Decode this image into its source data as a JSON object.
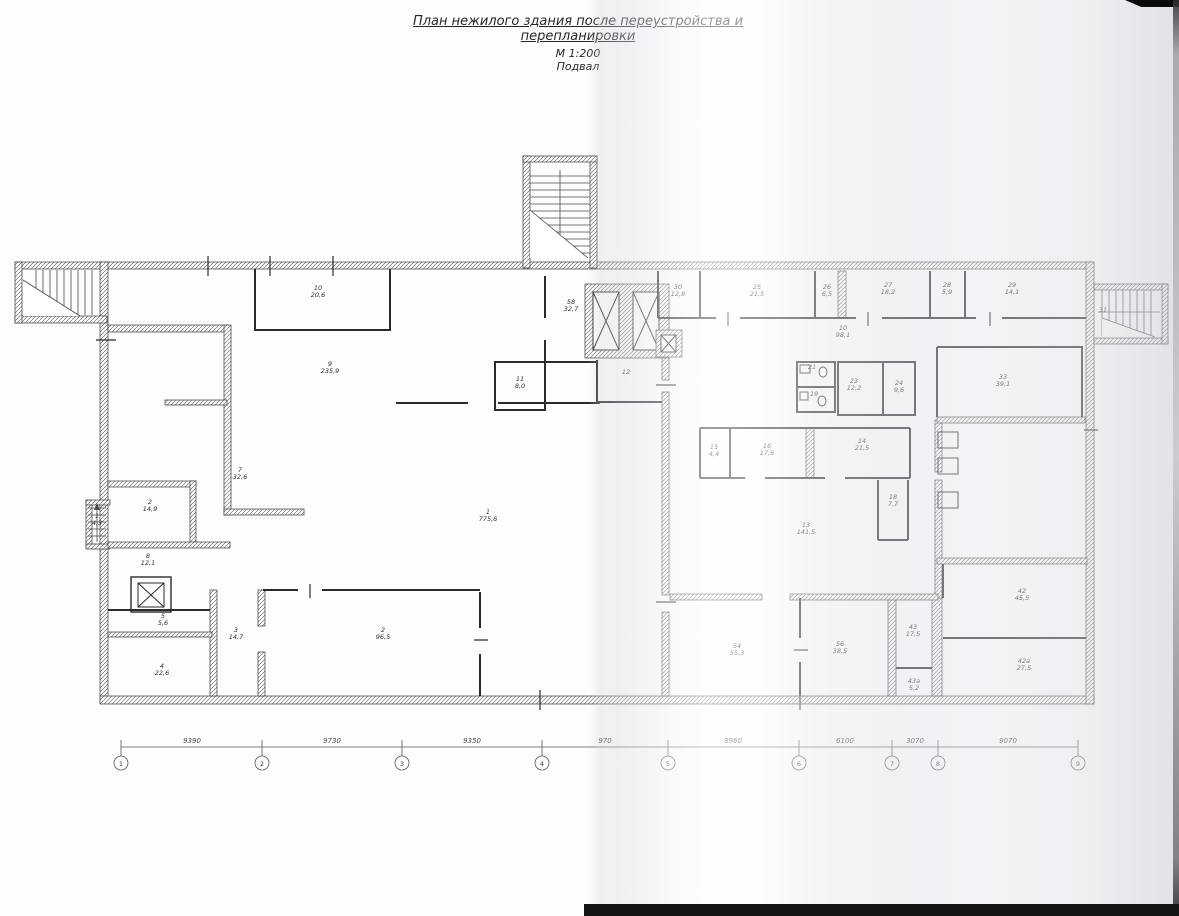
{
  "title": {
    "line1": "План нежилого здания после переустройства и перепланировки",
    "line2": "М 1:200",
    "line3": "Подвал"
  },
  "rooms": [
    {
      "num": "10",
      "area": "20,6"
    },
    {
      "num": "9",
      "area": "235,9"
    },
    {
      "num": "7",
      "area": "32,6"
    },
    {
      "num": "2",
      "area": "14,9"
    },
    {
      "num": "1",
      "area": "4,3"
    },
    {
      "num": "8",
      "area": "12,1"
    },
    {
      "num": "5",
      "area": "5,6"
    },
    {
      "num": "4",
      "area": "22,6"
    },
    {
      "num": "3",
      "area": "14,7"
    },
    {
      "num": "2",
      "area": "96,5"
    },
    {
      "num": "1",
      "area": "775,6"
    },
    {
      "num": "11",
      "area": "8,0"
    },
    {
      "num": "58",
      "area": "32,7"
    },
    {
      "num": "12",
      "area": ""
    },
    {
      "num": "30",
      "area": "12,8"
    },
    {
      "num": "25",
      "area": "21,5"
    },
    {
      "num": "26",
      "area": "6,5"
    },
    {
      "num": "27",
      "area": "18,2"
    },
    {
      "num": "28",
      "area": "5,9"
    },
    {
      "num": "29",
      "area": "14,1"
    },
    {
      "num": "31",
      "area": ""
    },
    {
      "num": "10",
      "area": "98,1"
    },
    {
      "num": "21",
      "area": ""
    },
    {
      "num": "19",
      "area": ""
    },
    {
      "num": "23",
      "area": "12,2"
    },
    {
      "num": "24",
      "area": "9,6"
    },
    {
      "num": "33",
      "area": "39,1"
    },
    {
      "num": "15",
      "area": "4,4"
    },
    {
      "num": "16",
      "area": "17,6"
    },
    {
      "num": "14",
      "area": "21,5"
    },
    {
      "num": "18",
      "area": "7,7"
    },
    {
      "num": "13",
      "area": "141,5"
    },
    {
      "num": "54",
      "area": "55,3"
    },
    {
      "num": "56",
      "area": "38,5"
    },
    {
      "num": "43",
      "area": "17,5"
    },
    {
      "num": "43а",
      "area": "5,2"
    },
    {
      "num": "42",
      "area": "45,5"
    },
    {
      "num": "42а",
      "area": "27,5"
    }
  ],
  "axes": {
    "bubbles": [
      "1",
      "2",
      "3",
      "4",
      "5",
      "6",
      "7",
      "8",
      "9"
    ],
    "dims": [
      "9390",
      "9730",
      "9350",
      "970",
      "8960",
      "6100",
      "3070",
      "9070"
    ]
  },
  "colors": {
    "line": "#2b2b2f",
    "paper": "#ffffff",
    "scan_band": "#e4e5ea"
  }
}
